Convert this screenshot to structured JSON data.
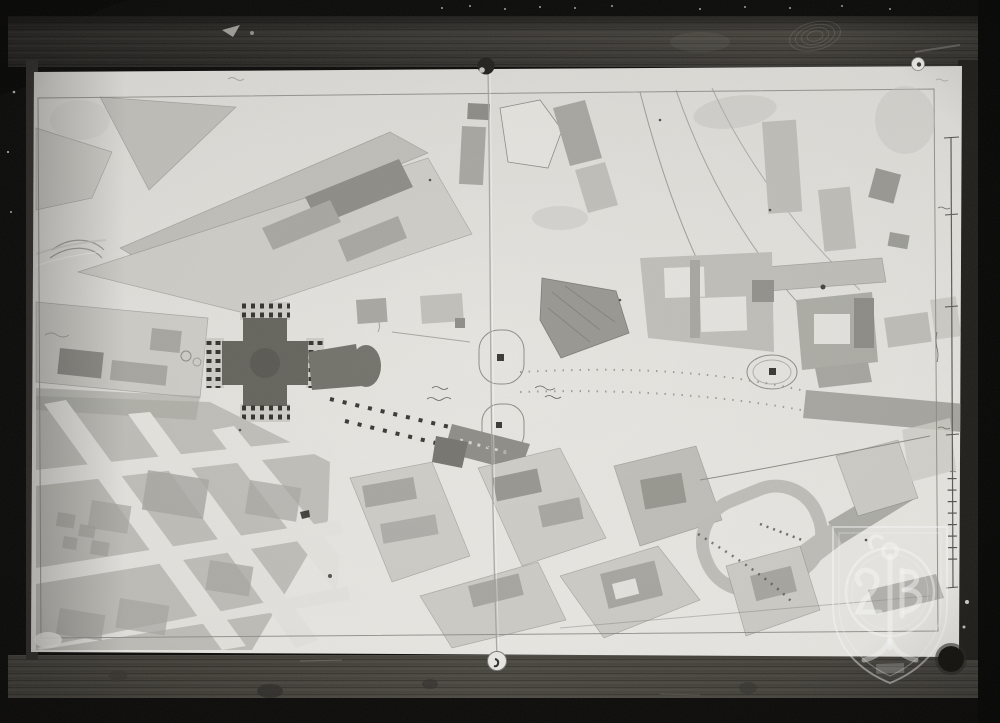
{
  "meta": {
    "description": "Black-and-white photograph of a hand-drawn historic city plan pinned to a dark wooden board; a Greek-cross church plan at left, radiating streets and washed building blocks, a vertical scale bar at right, a centre fold seam, and a translucent shield-monogram archive stamp at lower right"
  },
  "palette": {
    "plate_black": "#0b0b0a",
    "wood_dark": "#2e2c28",
    "wood_mid": "#4a4742",
    "wood_light": "#5a564e",
    "wood_bottom": "#454239",
    "paper": "#e2e1dc",
    "paper_bright": "#edece7",
    "street": "#e6e5e0",
    "block_light": "#cfcec8",
    "block_mid": "#c1c0ba",
    "block_dark": "#a9a8a2",
    "building_dark": "#8f8e88",
    "building_darker": "#777670",
    "church_dark": "#66655e",
    "church_mid": "#74736c",
    "pencil": "#8e8d87",
    "outline": "#706f69",
    "ink": "#3a3934",
    "watermark": "rgba(255,255,255,0.5)"
  },
  "plan": {
    "central_feature": "greek-cross-church-with-colonnaded-porches",
    "secondary_features": [
      "attached-apse-building",
      "two-outlined-squares-on-fold",
      "oval-plaza-with-monument",
      "racetrack-shaped-ring",
      "diagonal-street-grid-southwest",
      "courtyard-complexes-northeast",
      "hatched-garden-trapezoid"
    ]
  },
  "scale_bar": {
    "orientation": "vertical",
    "major_tick_count": 4,
    "minor_tick_count": 9
  },
  "pins": [
    {
      "id": "pin-top-center"
    },
    {
      "id": "pin-top-right"
    },
    {
      "id": "pin-bottom-center"
    }
  ],
  "watermark": {
    "type": "shield-with-circle-and-monogram-stamp"
  },
  "board": {
    "material": "wood-grain",
    "defects": [
      "knot-hole-bottom-right",
      "fingerprint-smudge-top",
      "stains",
      "scratches"
    ]
  }
}
